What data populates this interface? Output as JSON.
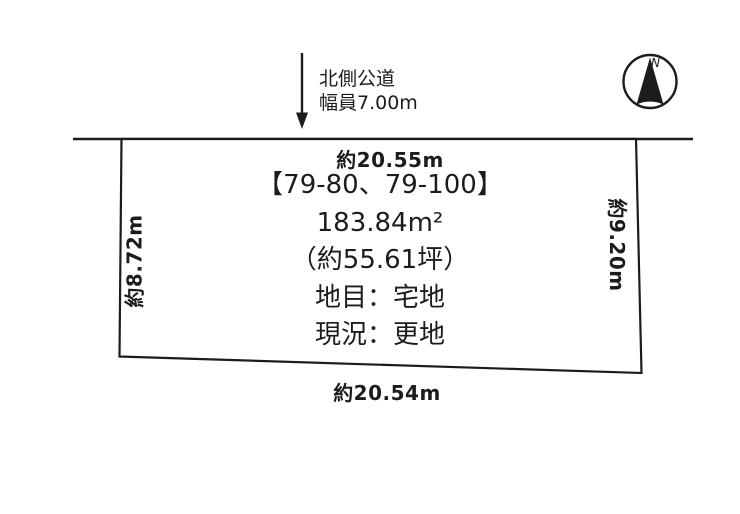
{
  "colors": {
    "ink": "#1c1c1c",
    "background": "#ffffff"
  },
  "road": {
    "name_label": "北側公道",
    "width_label": "幅員7.00m"
  },
  "compass": {
    "north_label": "N"
  },
  "plot": {
    "parcel_numbers": "【79-80、79-100】",
    "area_sqm": "183.84m²",
    "area_tsubo": "（約55.61坪）",
    "land_category": "地目：宅地",
    "current_status": "現況：更地",
    "dimensions": {
      "top": "約20.55m",
      "bottom": "約20.54m",
      "left": "約8.72m",
      "right": "約9.20m"
    }
  }
}
